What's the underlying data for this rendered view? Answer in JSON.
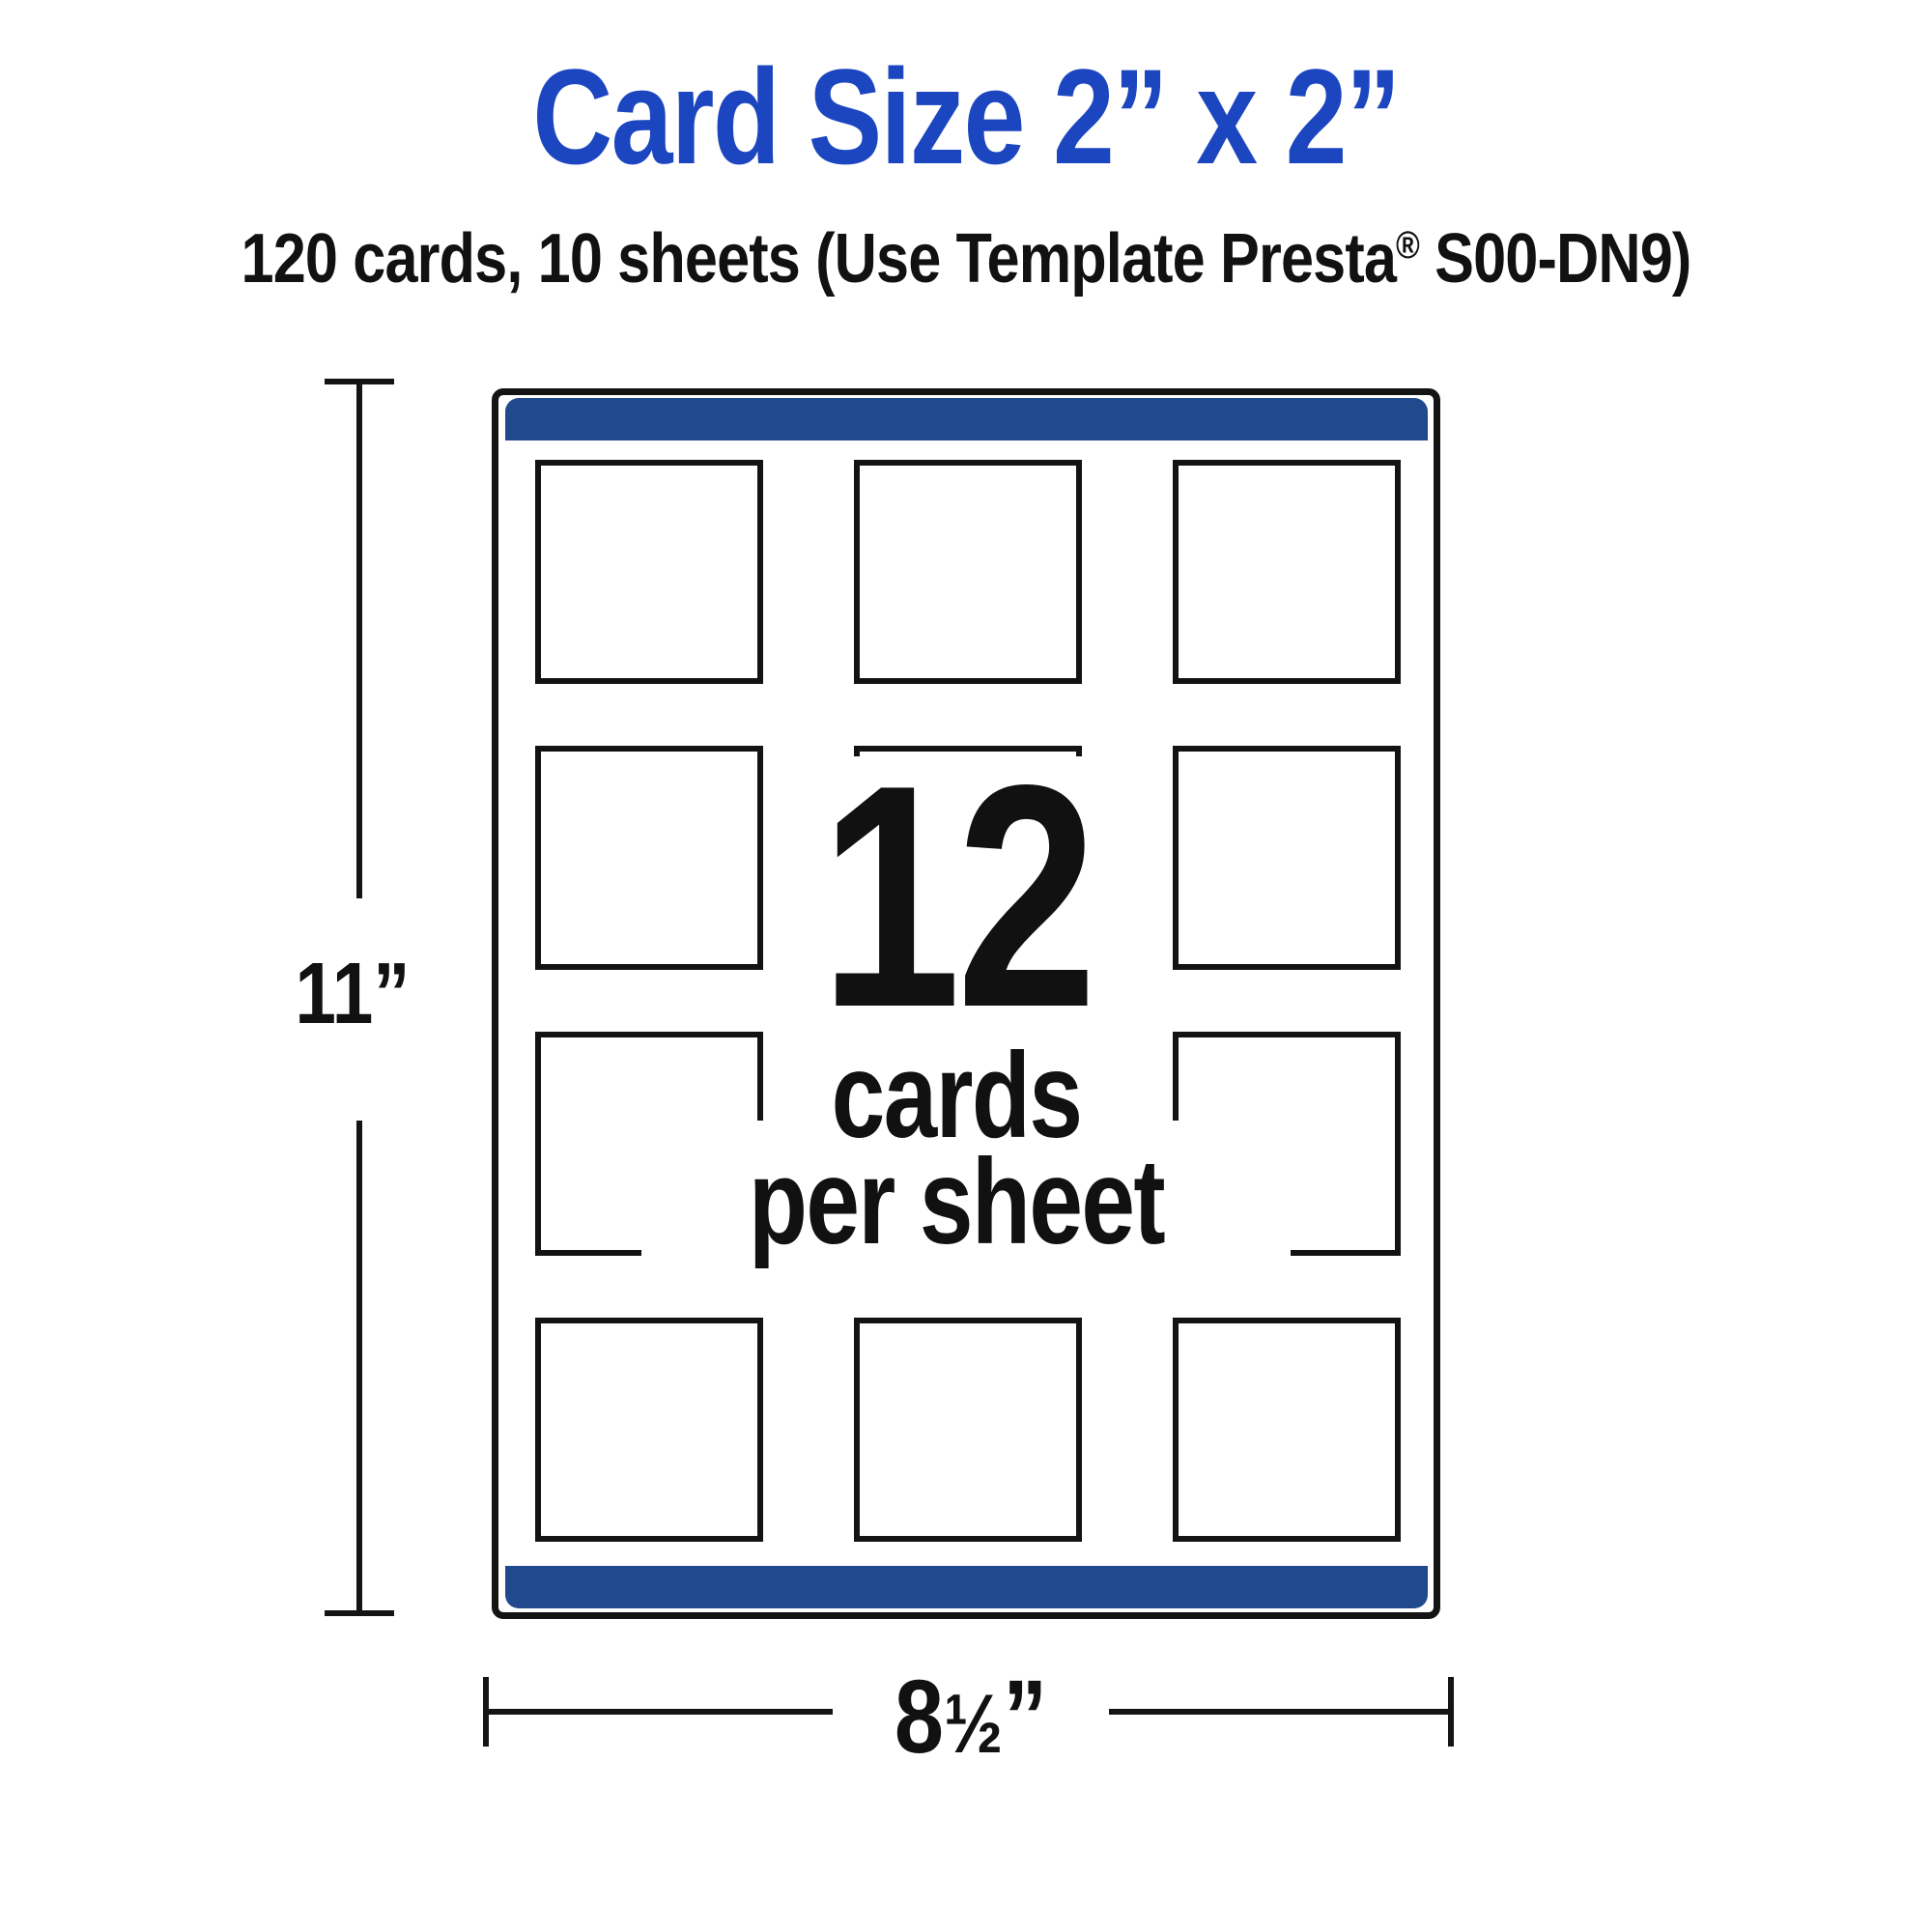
{
  "title": {
    "text": "Card Size 2” x 2”",
    "color": "#1c46c0"
  },
  "subtitle": {
    "prefix": "120 cards, 10 sheets (Use Template Presta",
    "trademark": "®",
    "suffix": " S00-DN9)"
  },
  "sheet": {
    "rows": 4,
    "cols": 3,
    "border_color": "#141414",
    "bar_color": "#21498e",
    "center_label": {
      "count": "12",
      "line1": "cards",
      "line2": "per sheet"
    }
  },
  "dimensions": {
    "height": {
      "label": "11”"
    },
    "width": {
      "whole": "8",
      "fraction": "½",
      "unit": "”"
    }
  }
}
